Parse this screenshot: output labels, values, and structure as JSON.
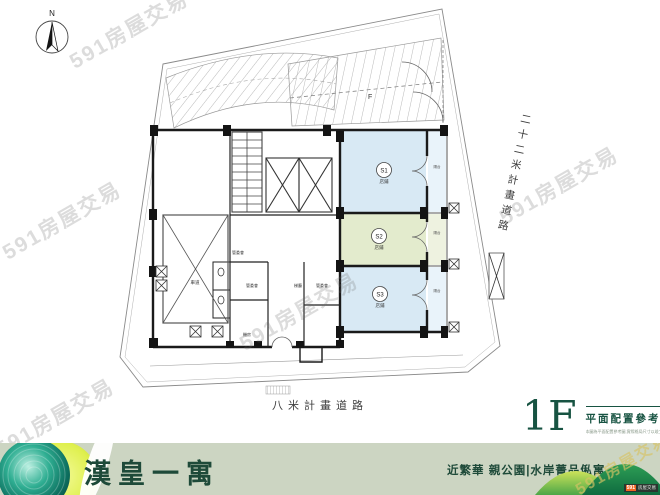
{
  "watermark_text": "591房屋交易",
  "compass": {
    "north_label": "N"
  },
  "plan": {
    "ramp_marker": "F",
    "driveway_label": "車道",
    "balcony_label": "陽台",
    "units": [
      {
        "id": "S1",
        "type_label": "店鋪"
      },
      {
        "id": "S2",
        "type_label": "店鋪"
      },
      {
        "id": "S3",
        "type_label": "店鋪"
      }
    ],
    "room_labels": [
      "管委會",
      "管委會",
      "梯廳",
      "管委會",
      "機房"
    ]
  },
  "roads": {
    "right_road": "二十二米計畫道路",
    "bottom_road": "八米計畫道路"
  },
  "title_block": {
    "floor": "1F",
    "title": "平面配置參考圖",
    "disclaimer": "本圖為平面配置參考圖,實際格局尺寸以竣工圖及現場為準"
  },
  "footer": {
    "project_name": "漢皇一寓",
    "tagline": "近繁華 親公園|水岸菁品俬寓",
    "badge_chip": "591",
    "badge_text": "房屋交易"
  },
  "colors": {
    "accent_green": "#175342",
    "unit_blue": "#d8e9f4",
    "unit_green": "#e3ebcd",
    "footer_bg": "#ccd5c2",
    "badge_orange": "#f26522"
  }
}
